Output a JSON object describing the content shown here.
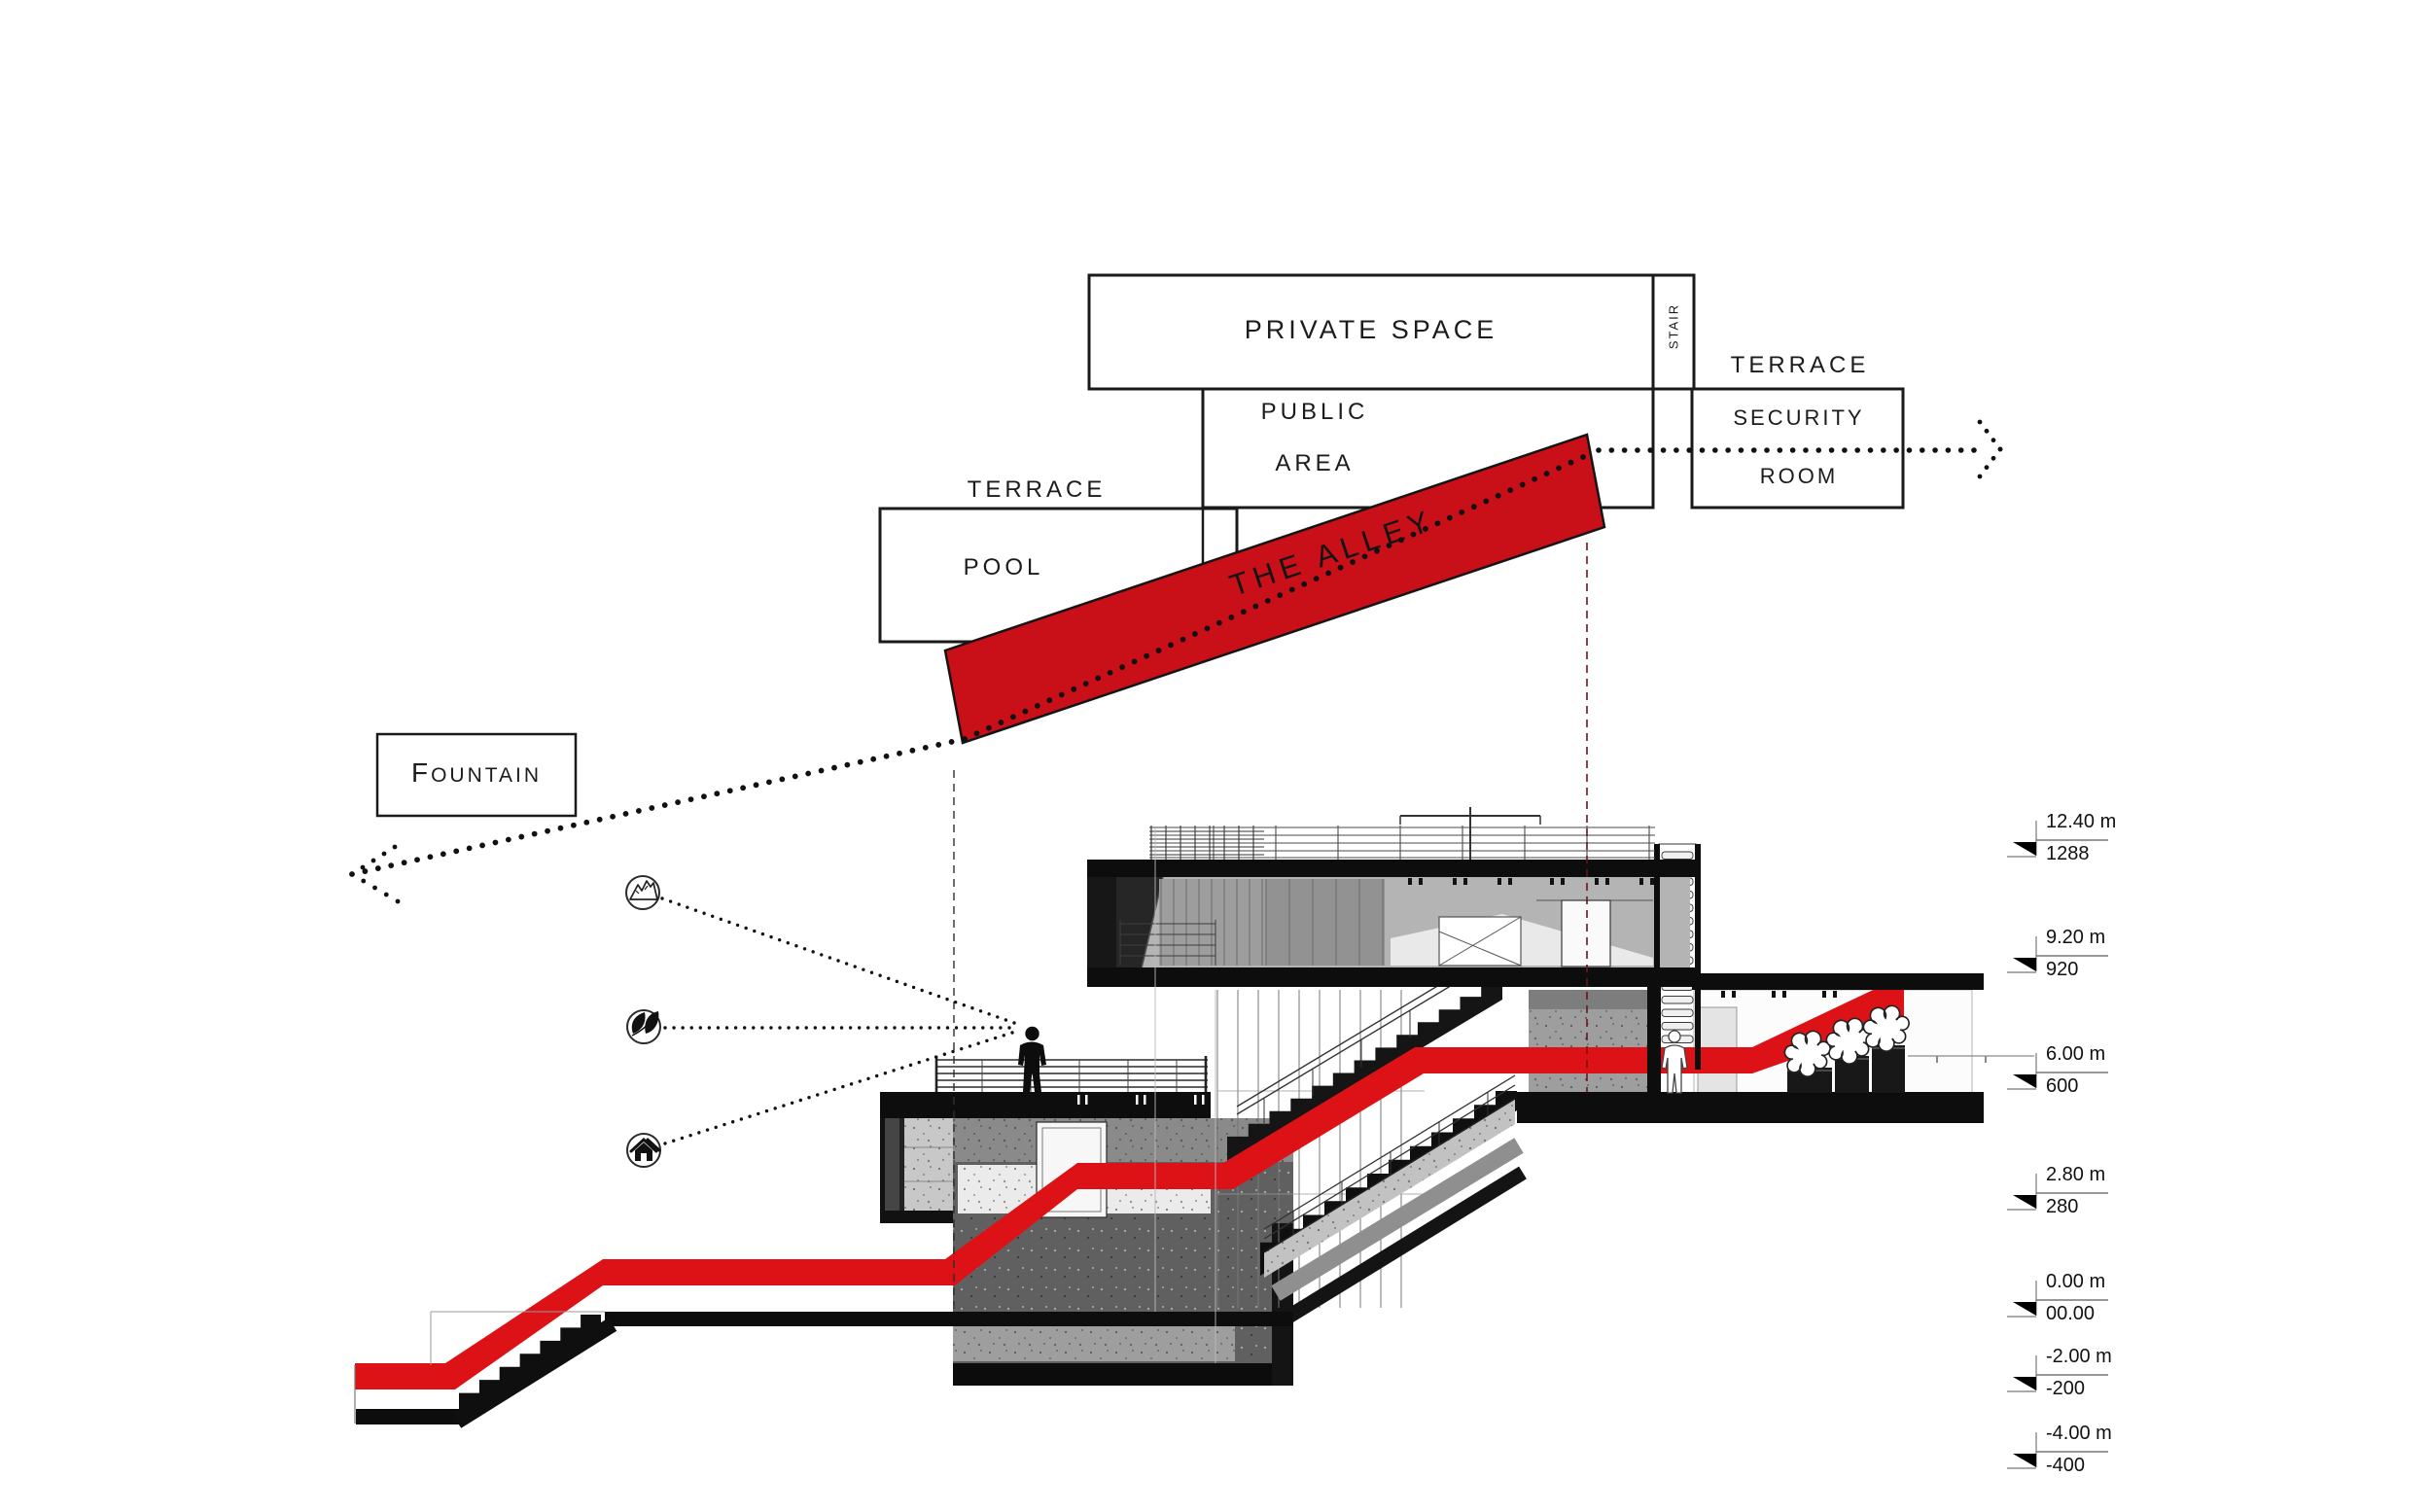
{
  "program_labels": {
    "private_space": "PRIVATE SPACE",
    "stair": "STAIR",
    "terrace_upper": "TERRACE",
    "security_room": [
      "SECURITY",
      "ROOM"
    ],
    "public_area": [
      "PUBLIC",
      "AREA"
    ],
    "terrace_lower": "TERRACE",
    "pool": "POOL",
    "the_alley": "THE ALLEY",
    "fountain": "FOUNTAIN"
  },
  "elevation_markers": [
    {
      "elevation": "12.40 m",
      "value": "1288"
    },
    {
      "elevation": "9.20 m",
      "value": "920"
    },
    {
      "elevation": "6.00 m",
      "value": "600"
    },
    {
      "elevation": "2.80 m",
      "value": "280"
    },
    {
      "elevation": "0.00 m",
      "value": "00.00"
    },
    {
      "elevation": "-2.00 m",
      "value": "-200"
    },
    {
      "elevation": "-4.00 m",
      "value": "-400"
    }
  ],
  "view_icons": [
    {
      "name": "mountain-icon"
    },
    {
      "name": "leaf-icon"
    },
    {
      "name": "house-icon"
    }
  ],
  "colors": {
    "alley_red": "#c90f18",
    "route_red": "#dc1217",
    "outline": "#1a1a1a",
    "dashed_maroon": "#6e1414"
  }
}
